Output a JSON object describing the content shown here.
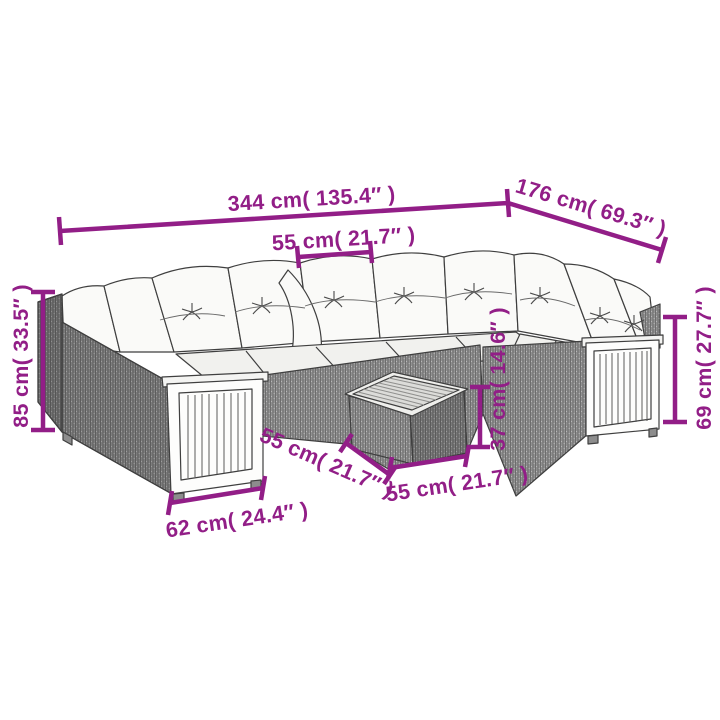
{
  "diagram": {
    "type": "product-dimension-diagram",
    "subject": "rattan corner sofa set with cushions, slatted wood armrests and square table",
    "accent_color": "#921e87",
    "background_color": "#ffffff",
    "linework_color": "#3f3f3f"
  },
  "dimensions": {
    "total_width": {
      "label": "344 cm( 135.4″ )",
      "cm": "344",
      "inches": "135.4"
    },
    "total_depth": {
      "label": "176 cm( 69.3″ )",
      "cm": "176",
      "inches": "69.3"
    },
    "seat_width": {
      "label": "55 cm( 21.7″ )",
      "cm": "55",
      "inches": "21.7"
    },
    "back_height": {
      "label": "85 cm( 33.5″ )",
      "cm": "85",
      "inches": "33.5"
    },
    "arm_height": {
      "label": "69 cm( 27.7″ )",
      "cm": "69",
      "inches": "27.7"
    },
    "table_height": {
      "label": "37 cm( 14.6″ )",
      "cm": "37",
      "inches": "14.6"
    },
    "table_depth": {
      "label": "55 cm( 21.7″ )",
      "cm": "55",
      "inches": "21.7"
    },
    "table_width": {
      "label": "55 cm( 21.7″ )",
      "cm": "55",
      "inches": "21.7"
    },
    "arm_panel_width": {
      "label": "62 cm( 24.4″ )",
      "cm": "62",
      "inches": "24.4"
    }
  }
}
